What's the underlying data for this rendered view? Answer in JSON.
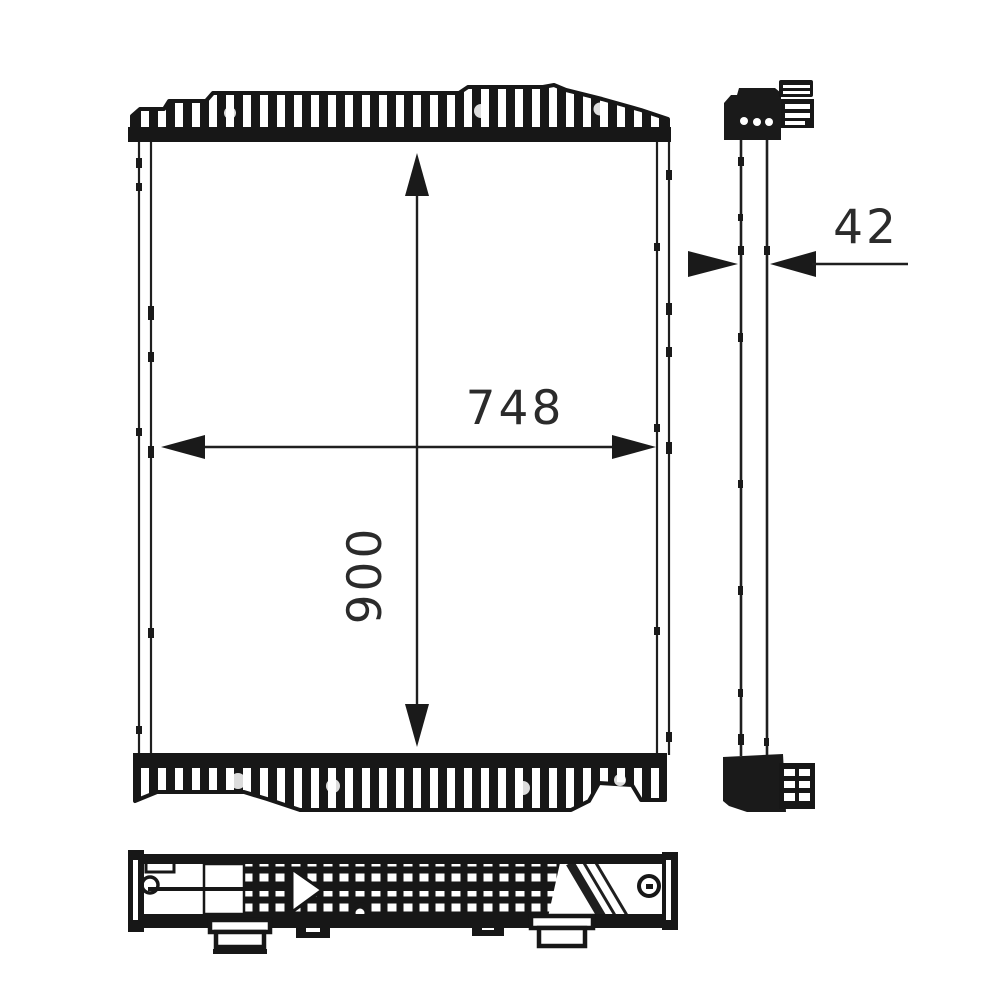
{
  "page": {
    "background_color": "#ffffff",
    "line_color": "#1a1a1a"
  },
  "drawing": {
    "subject": "radiator-three-view-technical-drawing",
    "views": {
      "front": "front-view",
      "side": "side-profile-view",
      "bottom": "bottom-view"
    },
    "dimensions": {
      "width": "748",
      "height": "900",
      "depth": "42"
    }
  }
}
